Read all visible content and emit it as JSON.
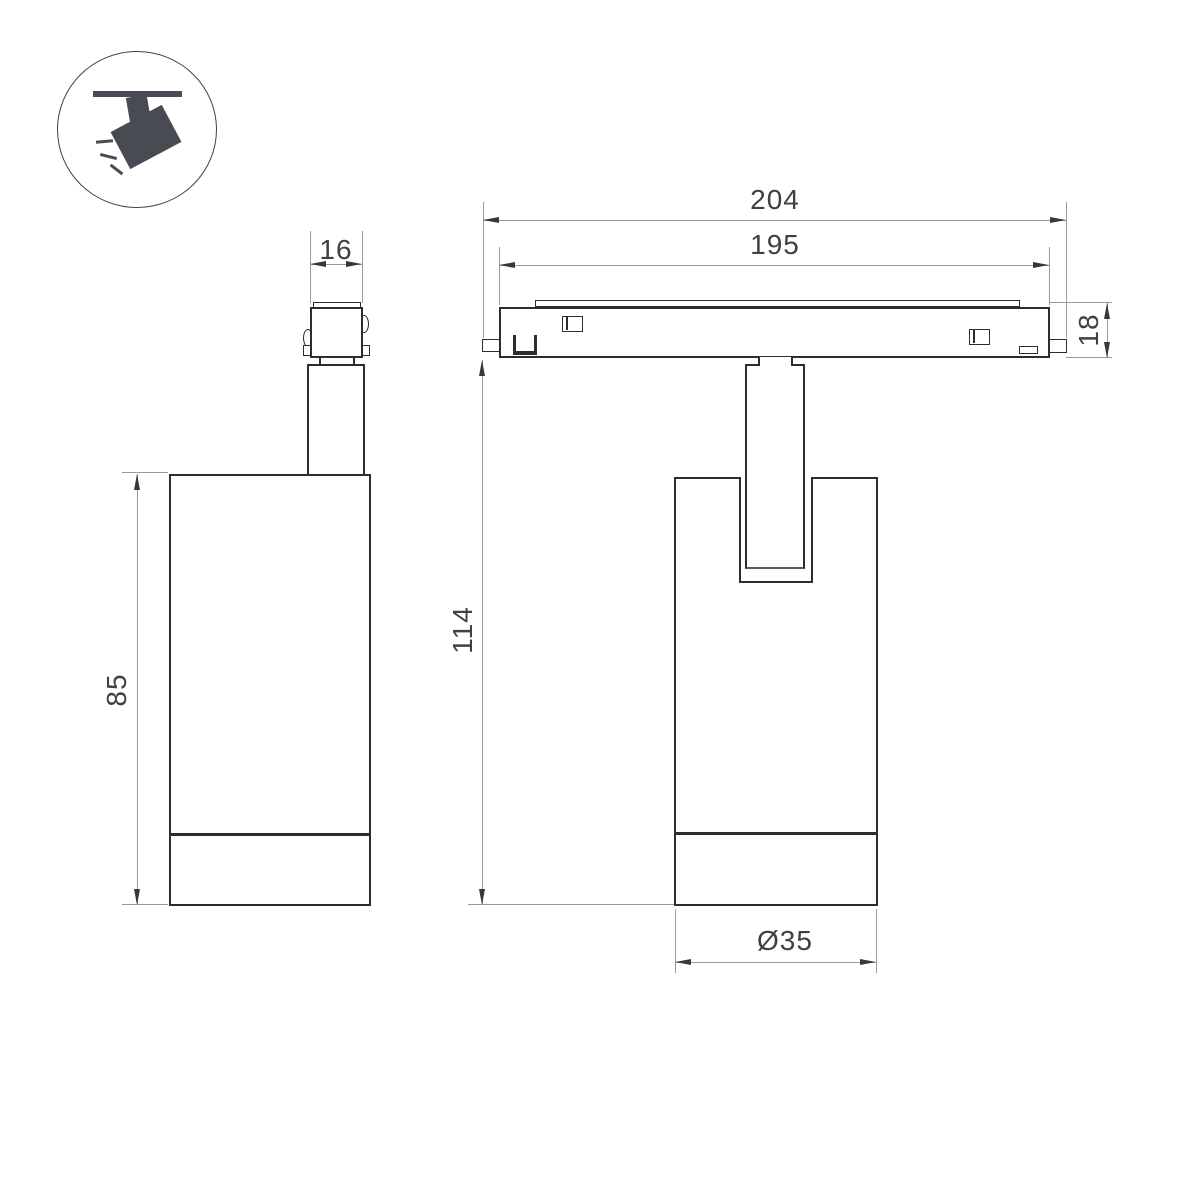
{
  "colors": {
    "background": "#ffffff",
    "outline": "#2d2d30",
    "dimension_line": "#9a9a9a",
    "dimension_text": "#3f4042",
    "icon": "#484c52"
  },
  "icon": {
    "name": "track-spotlight-icon"
  },
  "views": {
    "front": {
      "dims": {
        "connector_width": "16",
        "body_height": "85"
      }
    },
    "side": {
      "dims": {
        "total_length": "204",
        "track_length": "195",
        "track_height": "18",
        "overall_height": "114",
        "body_diameter": "Ø35"
      }
    }
  }
}
